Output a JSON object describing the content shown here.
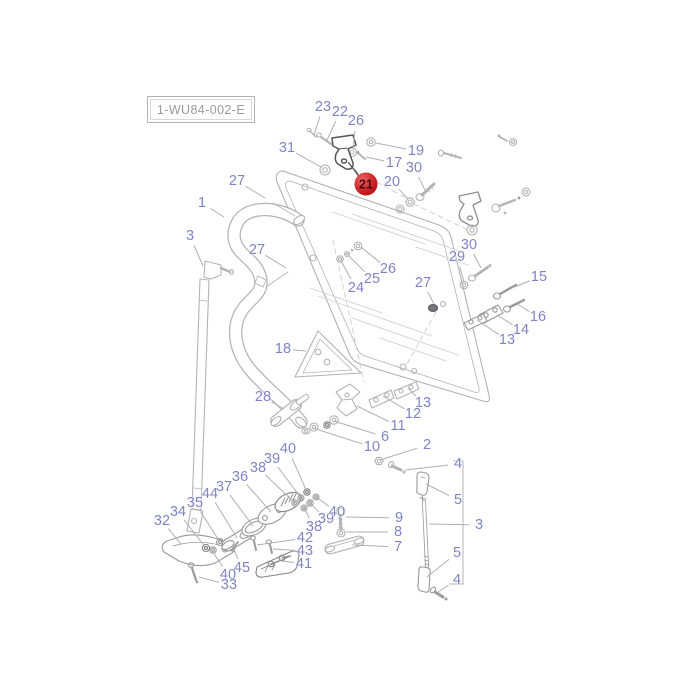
{
  "diagram": {
    "code_label": "1-WU84-002-E",
    "highlight": {
      "t": "21",
      "x": 366,
      "y": 184,
      "lx": 348,
      "ly": 162
    },
    "callouts": [
      {
        "t": "23",
        "x": 323,
        "y": 107,
        "lx": 314,
        "ly": 135
      },
      {
        "t": "22",
        "x": 340,
        "y": 112,
        "lx": 327,
        "ly": 140
      },
      {
        "t": "26",
        "x": 356,
        "y": 121,
        "lx": 353,
        "ly": 149
      },
      {
        "t": "31",
        "x": 287,
        "y": 148,
        "lx": 321,
        "ly": 167
      },
      {
        "t": "19",
        "x": 416,
        "y": 151,
        "lx": 376,
        "ly": 143
      },
      {
        "t": "17",
        "x": 394,
        "y": 163,
        "lx": 366,
        "ly": 157
      },
      {
        "t": "30",
        "x": 414,
        "y": 168,
        "lx": 425,
        "ly": 190
      },
      {
        "t": "20",
        "x": 392,
        "y": 182,
        "lx": 408,
        "ly": 199
      },
      {
        "t": "27",
        "x": 237,
        "y": 181,
        "lx": 265,
        "ly": 198
      },
      {
        "t": "1",
        "x": 202,
        "y": 203,
        "lx": 224,
        "ly": 217
      },
      {
        "t": "3",
        "x": 190,
        "y": 236,
        "lx": 203,
        "ly": 266
      },
      {
        "t": "27",
        "x": 257,
        "y": 250,
        "lx": 286,
        "ly": 268
      },
      {
        "t": "24",
        "x": 356,
        "y": 288,
        "lx": 341,
        "ly": 261
      },
      {
        "t": "25",
        "x": 372,
        "y": 279,
        "lx": 349,
        "ly": 256
      },
      {
        "t": "26",
        "x": 388,
        "y": 269,
        "lx": 361,
        "ly": 247
      },
      {
        "t": "27",
        "x": 423,
        "y": 283,
        "lx": 434,
        "ly": 304
      },
      {
        "t": "29",
        "x": 457,
        "y": 257,
        "lx": 464,
        "ly": 282
      },
      {
        "t": "30",
        "x": 469,
        "y": 245,
        "lx": 481,
        "ly": 268
      },
      {
        "t": "15",
        "x": 539,
        "y": 277,
        "lx": 512,
        "ly": 288
      },
      {
        "t": "16",
        "x": 538,
        "y": 317,
        "lx": 517,
        "ly": 304
      },
      {
        "t": "14",
        "x": 521,
        "y": 330,
        "lx": 497,
        "ly": 315
      },
      {
        "t": "13",
        "x": 507,
        "y": 340,
        "lx": 477,
        "ly": 320
      },
      {
        "t": "18",
        "x": 283,
        "y": 349,
        "lx": 306,
        "ly": 351
      },
      {
        "t": "28",
        "x": 263,
        "y": 397,
        "lx": 284,
        "ly": 409
      },
      {
        "t": "13",
        "x": 423,
        "y": 403,
        "lx": 408,
        "ly": 388
      },
      {
        "t": "12",
        "x": 413,
        "y": 414,
        "lx": 383,
        "ly": 396
      },
      {
        "t": "11",
        "x": 398,
        "y": 426,
        "lx": 357,
        "ly": 406
      },
      {
        "t": "6",
        "x": 385,
        "y": 437,
        "lx": 334,
        "ly": 421
      },
      {
        "t": "10",
        "x": 372,
        "y": 447,
        "lx": 313,
        "ly": 428
      },
      {
        "t": "2",
        "x": 427,
        "y": 445,
        "lx": 380,
        "ly": 460
      },
      {
        "t": "4",
        "x": 458,
        "y": 464,
        "lx": 405,
        "ly": 470
      },
      {
        "t": "5",
        "x": 458,
        "y": 500,
        "lx": 426,
        "ly": 484
      },
      {
        "t": "3",
        "x": 479,
        "y": 525,
        "lx": 429,
        "ly": 524
      },
      {
        "t": "5",
        "x": 457,
        "y": 553,
        "lx": 427,
        "ly": 577
      },
      {
        "t": "4",
        "x": 457,
        "y": 580,
        "lx": 438,
        "ly": 592
      },
      {
        "t": "9",
        "x": 399,
        "y": 518,
        "lx": 346,
        "ly": 517
      },
      {
        "t": "8",
        "x": 398,
        "y": 532,
        "lx": 346,
        "ly": 532
      },
      {
        "t": "7",
        "x": 398,
        "y": 547,
        "lx": 352,
        "ly": 545
      },
      {
        "t": "40",
        "x": 288,
        "y": 449,
        "lx": 307,
        "ly": 492
      },
      {
        "t": "39",
        "x": 272,
        "y": 459,
        "lx": 301,
        "ly": 498
      },
      {
        "t": "38",
        "x": 258,
        "y": 468,
        "lx": 295,
        "ly": 503
      },
      {
        "t": "36",
        "x": 240,
        "y": 477,
        "lx": 271,
        "ly": 512
      },
      {
        "t": "37",
        "x": 224,
        "y": 487,
        "lx": 253,
        "ly": 526
      },
      {
        "t": "44",
        "x": 210,
        "y": 494,
        "lx": 237,
        "ly": 538
      },
      {
        "t": "35",
        "x": 195,
        "y": 503,
        "lx": 220,
        "ly": 542
      },
      {
        "t": "34",
        "x": 178,
        "y": 512,
        "lx": 206,
        "ly": 548
      },
      {
        "t": "32",
        "x": 162,
        "y": 521,
        "lx": 181,
        "ly": 544
      },
      {
        "t": "38",
        "x": 314,
        "y": 527,
        "lx": 304,
        "ly": 508
      },
      {
        "t": "39",
        "x": 326,
        "y": 519,
        "lx": 310,
        "ly": 503
      },
      {
        "t": "40",
        "x": 337,
        "y": 512,
        "lx": 316,
        "ly": 497
      },
      {
        "t": "42",
        "x": 305,
        "y": 538,
        "lx": 257,
        "ly": 545
      },
      {
        "t": "43",
        "x": 305,
        "y": 551,
        "lx": 273,
        "ly": 549
      },
      {
        "t": "41",
        "x": 304,
        "y": 564,
        "lx": 282,
        "ly": 561
      },
      {
        "t": "45",
        "x": 242,
        "y": 568,
        "lx": 234,
        "ly": 550
      },
      {
        "t": "40",
        "x": 228,
        "y": 575,
        "lx": 213,
        "ly": 552
      },
      {
        "t": "33",
        "x": 229,
        "y": 585,
        "lx": 199,
        "ly": 577
      }
    ]
  },
  "colors": {
    "callout_blue": "#8184c3",
    "art_gray": "#b3b3b7",
    "dark_part_gray": "#54545a",
    "highlight_red": "#c9191f",
    "code_text_gray": "#9a9a9a"
  }
}
